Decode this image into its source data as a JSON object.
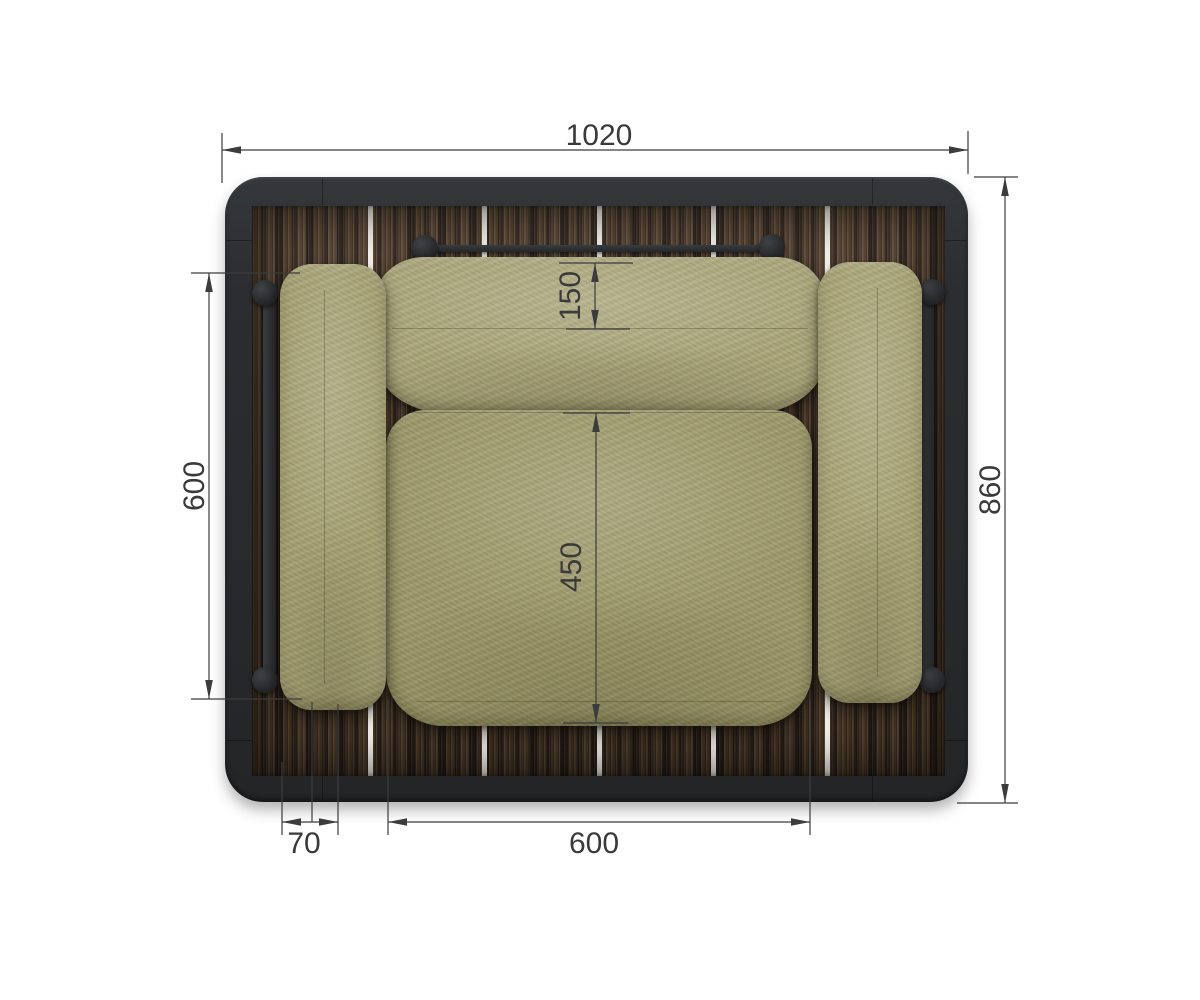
{
  "drawing": {
    "subject": "outdoor-armchair-top-view",
    "dimensions": {
      "overall_width": "1020",
      "overall_depth": "860",
      "armrest_length": "600",
      "backrest_depth": "150",
      "seat_depth": "450",
      "armrest_width": "70",
      "seat_width": "600"
    },
    "colors": {
      "background": "#ffffff",
      "frame": "#2b2d30",
      "wood_dark": "#3b2c23",
      "wood_light": "#5e4936",
      "plank_gap": "#f2efe9",
      "cushion_back": "#aba67a",
      "cushion_arm": "#a6a173",
      "cushion_seat": "#9d9869",
      "dimension_line": "#3c3c3c"
    }
  }
}
